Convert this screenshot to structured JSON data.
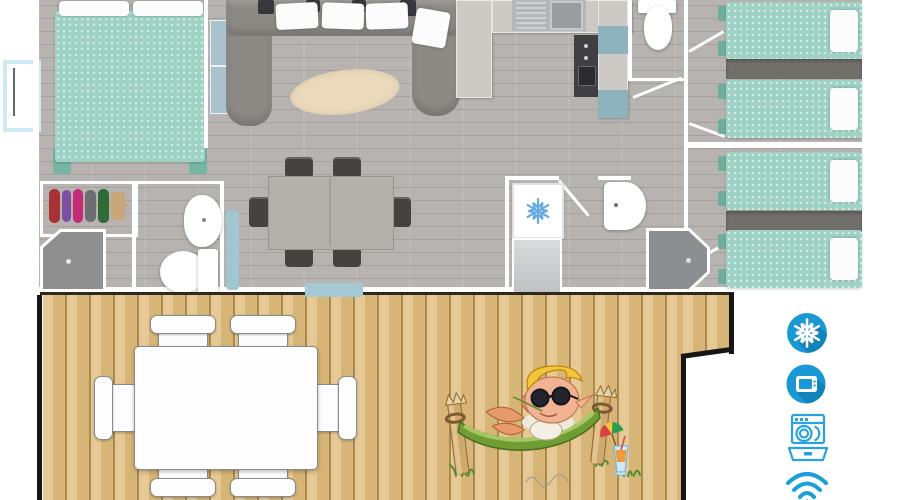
{
  "scene": {
    "description": "top-down 3D render of a mobile-home floor plan with front wooden terrace and amenity icons",
    "sections": [
      "interior-plan",
      "wood-terrace",
      "amenity-icons"
    ]
  },
  "palette": {
    "bed_teal": "#9ed2c4",
    "floor_gray": "#b6b3b0",
    "deck_wood": "#d7b576",
    "wall_white": "#ffffff",
    "sofa_gray": "#8d8a86",
    "icon_blue": "#1899d6",
    "icon_outline_blue": "#2aa2df",
    "window_blue": "#cfe9f4",
    "entrance_step_blue": "#a5c9d3"
  },
  "interior": {
    "rooms": [
      {
        "name": "master-bedroom",
        "furniture": [
          "double-bed",
          "side-cabinets",
          "wardrobe-with-clothes"
        ]
      },
      {
        "name": "shower-room-left",
        "furniture": [
          "corner-shower",
          "washbasin",
          "toilet",
          "bath-mat"
        ]
      },
      {
        "name": "living-room",
        "furniture": [
          "u-shaped-sofa",
          "three-back-pillows",
          "oval-rug",
          "dining-table",
          "six-chairs"
        ]
      },
      {
        "name": "kitchen",
        "furniture": [
          "sink-with-drainer",
          "cooker-column",
          "cabinets",
          "blue-accent-panels"
        ]
      },
      {
        "name": "wc",
        "furniture": [
          "toilet"
        ]
      },
      {
        "name": "bathroom-center",
        "furniture": [
          "air-conditioning-unit",
          "washbasin",
          "octagonal-shower"
        ]
      },
      {
        "name": "bedroom-twin-top",
        "furniture": [
          "single-bed",
          "single-bed",
          "headboard-shelf"
        ]
      },
      {
        "name": "bedroom-twin-bottom",
        "furniture": [
          "single-bed",
          "single-bed",
          "headboard-shelf"
        ]
      }
    ]
  },
  "terrace": {
    "furniture": [
      "outdoor-table",
      "six-outdoor-chairs"
    ],
    "artwork": "mascot-elf-relaxing-in-hammock-with-cocktail"
  },
  "amenities": {
    "accent_color": "#1899d6",
    "items": [
      {
        "icon": "snowflake-icon",
        "label": "air-conditioning"
      },
      {
        "icon": "tv-icon",
        "label": "television"
      },
      {
        "icon": "dishwasher-icon",
        "label": "dishwasher"
      },
      {
        "icon": "wifi-icon",
        "label": "wifi"
      }
    ]
  }
}
